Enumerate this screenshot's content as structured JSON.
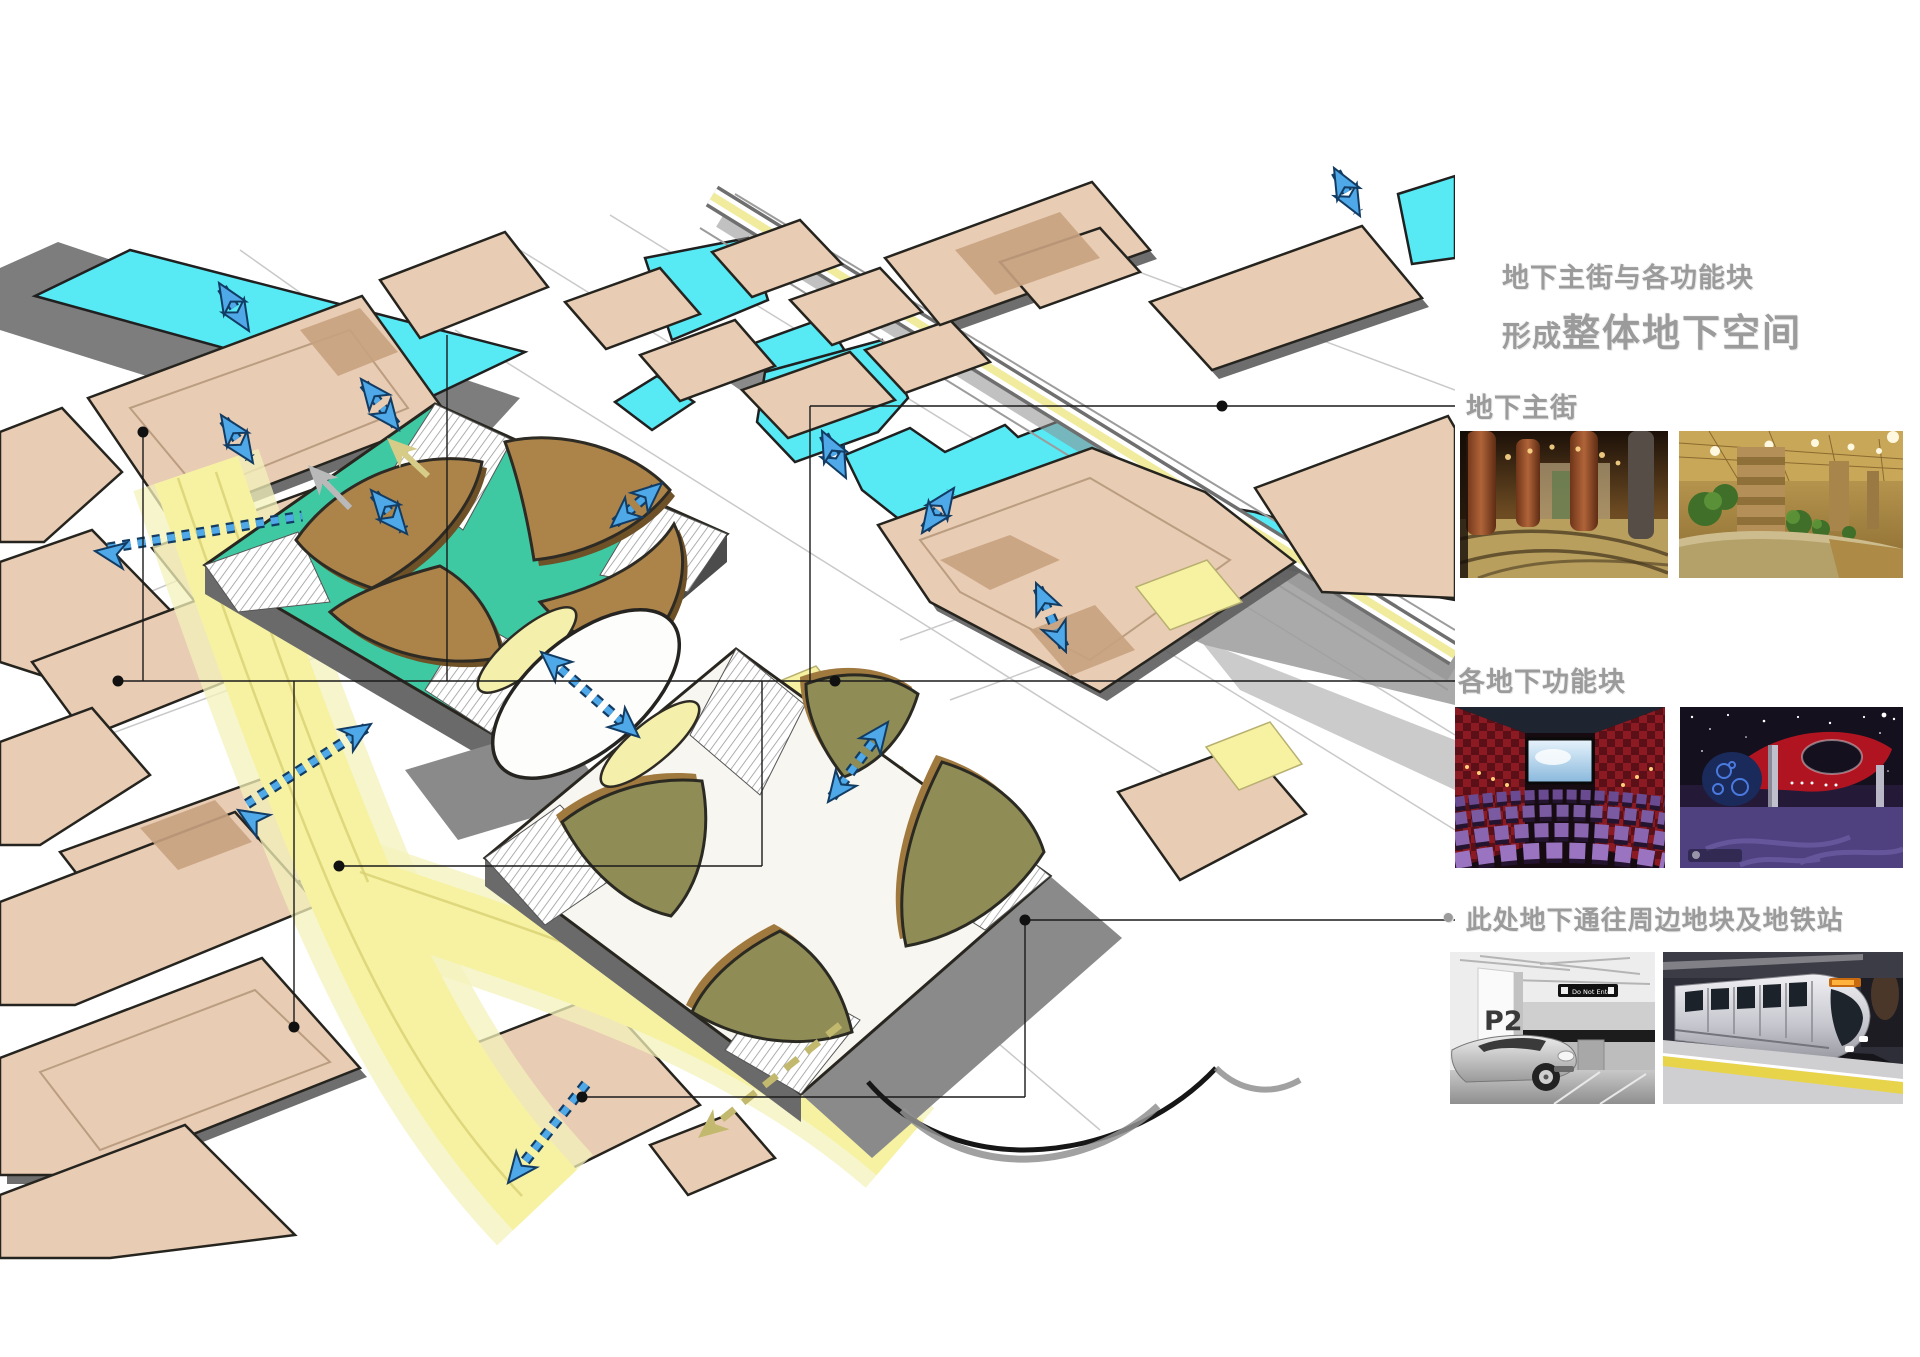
{
  "page": {
    "width": 1920,
    "height": 1357,
    "background": "#ffffff"
  },
  "annotations": {
    "text_color": "#9b9b9b",
    "title_line1": "地下主街与各功能块",
    "title_line2_prefix": "形成",
    "title_line2_emphasis": "整体地下空间",
    "sections": [
      {
        "label": "地下主街"
      },
      {
        "label": "各地下功能块"
      },
      {
        "bullet": "•",
        "label": "此处地下通往周边地块及地铁站"
      }
    ]
  },
  "photos": {
    "underground_street": [
      {
        "name": "column-hall-interior"
      },
      {
        "name": "planter-corridor-interior"
      }
    ],
    "function_blocks": [
      {
        "name": "cinema-auditorium"
      },
      {
        "name": "entertainment-hall"
      }
    ],
    "connections": [
      {
        "name": "parking-garage",
        "pillar_sign": "P2",
        "ceiling_sign": "Do Not Enter"
      },
      {
        "name": "metro-train"
      }
    ]
  },
  "diagram": {
    "colors": {
      "block_beige": "#e8ccb3",
      "block_patch_tan": "#c8a27f",
      "water_cyan": "#57e9f4",
      "road_yellow": "#f6f2a2",
      "deck_teal": "#3fc9a3",
      "ramp_brown": "#ac8449",
      "plaza_olive": "#8f8c55",
      "flow_arrow_blue": "#4fa9e9",
      "arrow_outline_navy": "#123c63",
      "shadow_gray": "#8a8a8a",
      "outline_black": "#26241f",
      "callout_line": "#1a1a1a"
    }
  }
}
